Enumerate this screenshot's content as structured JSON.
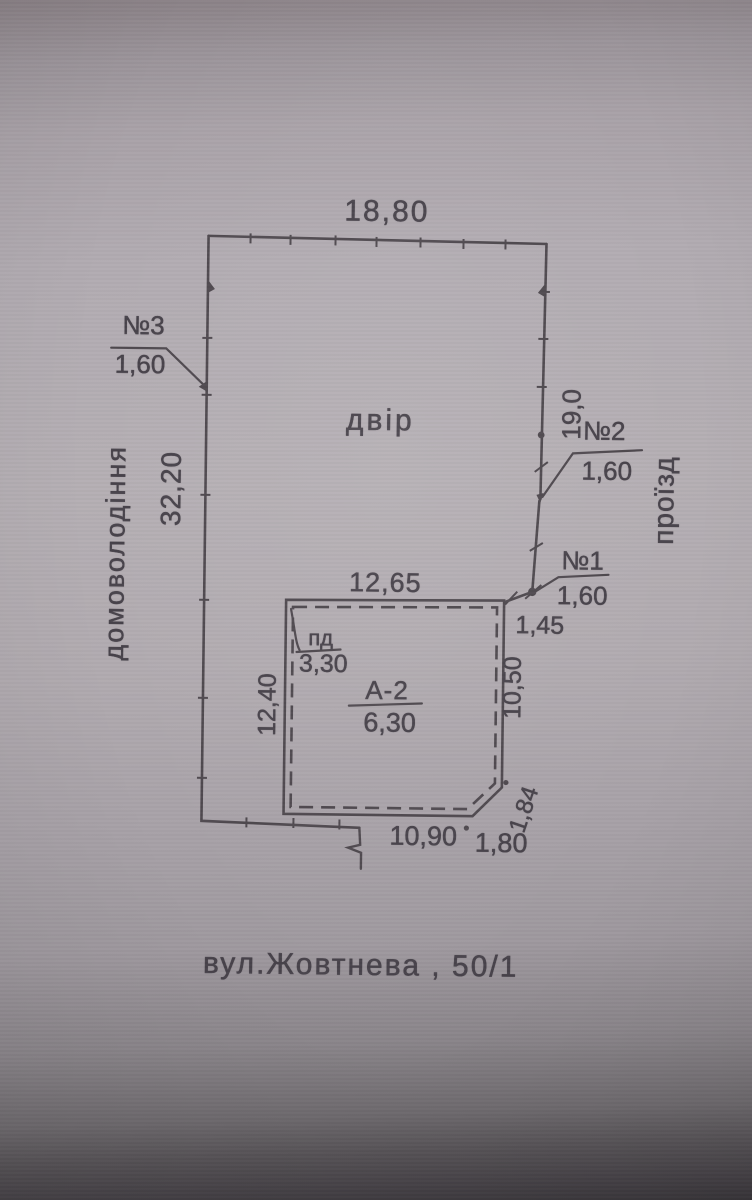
{
  "plan": {
    "street_address": "вул.Жовтнева , 50/1",
    "area_labels": {
      "yard": "двір",
      "homestead": "домоволодіння",
      "driveway": "проїзд"
    },
    "building": {
      "designation": "А-2",
      "value": "6,30",
      "annex_label": "пд",
      "annex_value": "3,30"
    },
    "dimensions": {
      "plot_top": "18,80",
      "plot_left": "32,20",
      "plot_right_upper": "19,0",
      "gap_ne": "1,45",
      "building_top": "12,65",
      "building_left": "12,40",
      "building_right": "10,50",
      "building_bottom": "10,90",
      "building_bottom_right": "1,80",
      "building_chamfer": "1,84"
    },
    "fence_markers": [
      {
        "id": "№3",
        "value": "1,60"
      },
      {
        "id": "№2",
        "value": "1,60"
      },
      {
        "id": "№1",
        "value": "1,60"
      }
    ]
  }
}
